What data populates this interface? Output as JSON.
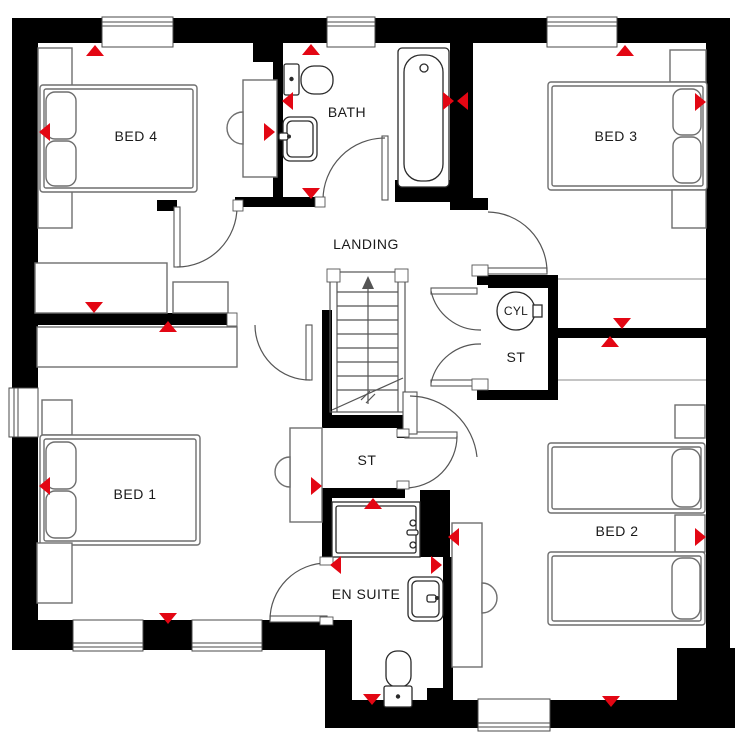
{
  "floor_plan": {
    "rooms": {
      "bed4": {
        "label": "BED 4"
      },
      "bath": {
        "label": "BATH"
      },
      "bed3": {
        "label": "BED 3"
      },
      "landing": {
        "label": "LANDING"
      },
      "cylinder": {
        "label": "CYL"
      },
      "store_cupboard": {
        "label": "ST"
      },
      "bed1": {
        "label": "BED 1"
      },
      "store_understairs": {
        "label": "ST"
      },
      "ensuite": {
        "label": "EN SUITE"
      },
      "bed2": {
        "label": "BED 2"
      }
    },
    "colors": {
      "wall": "#000000",
      "marker_red": "#e30613",
      "furniture_line": "#6e6e6e",
      "fixture_line": "#2a2a2a"
    }
  }
}
